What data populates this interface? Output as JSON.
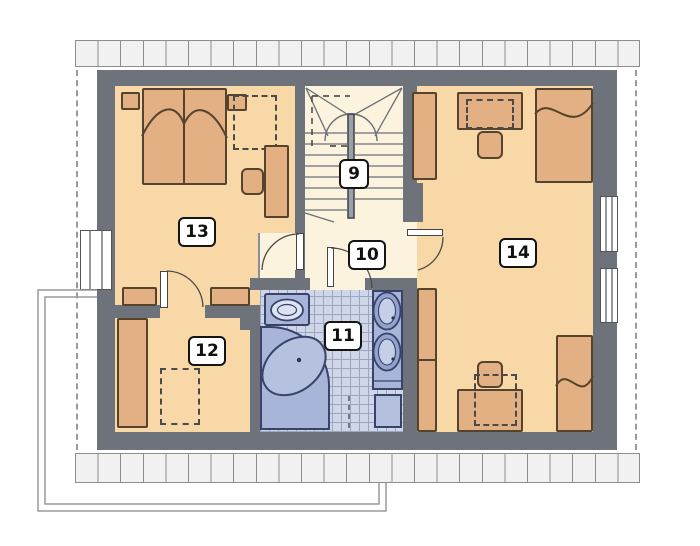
{
  "plan": {
    "title": "attic floor plan",
    "room_labels": {
      "staircase": "9",
      "hallway": "10",
      "bathroom": "11",
      "storage": "12",
      "bedroom_left": "13",
      "bedroom_right": "14"
    }
  },
  "colors": {
    "wall": "#6e727b",
    "room_floor": "#f9d8a8",
    "hall_floor": "#fbf3dd",
    "furniture": "#e2b083",
    "furniture_outline": "#55432e",
    "bath_fixture": "#a9b5d8",
    "bath_fixture_outline": "#39436a",
    "bath_tile": "#cfd6e8",
    "tile_grid": "#9aa5c2",
    "eave_fill": "#f1f1f1",
    "eave_line": "#8d8d8d",
    "outline_gray": "#9a9a9a"
  }
}
